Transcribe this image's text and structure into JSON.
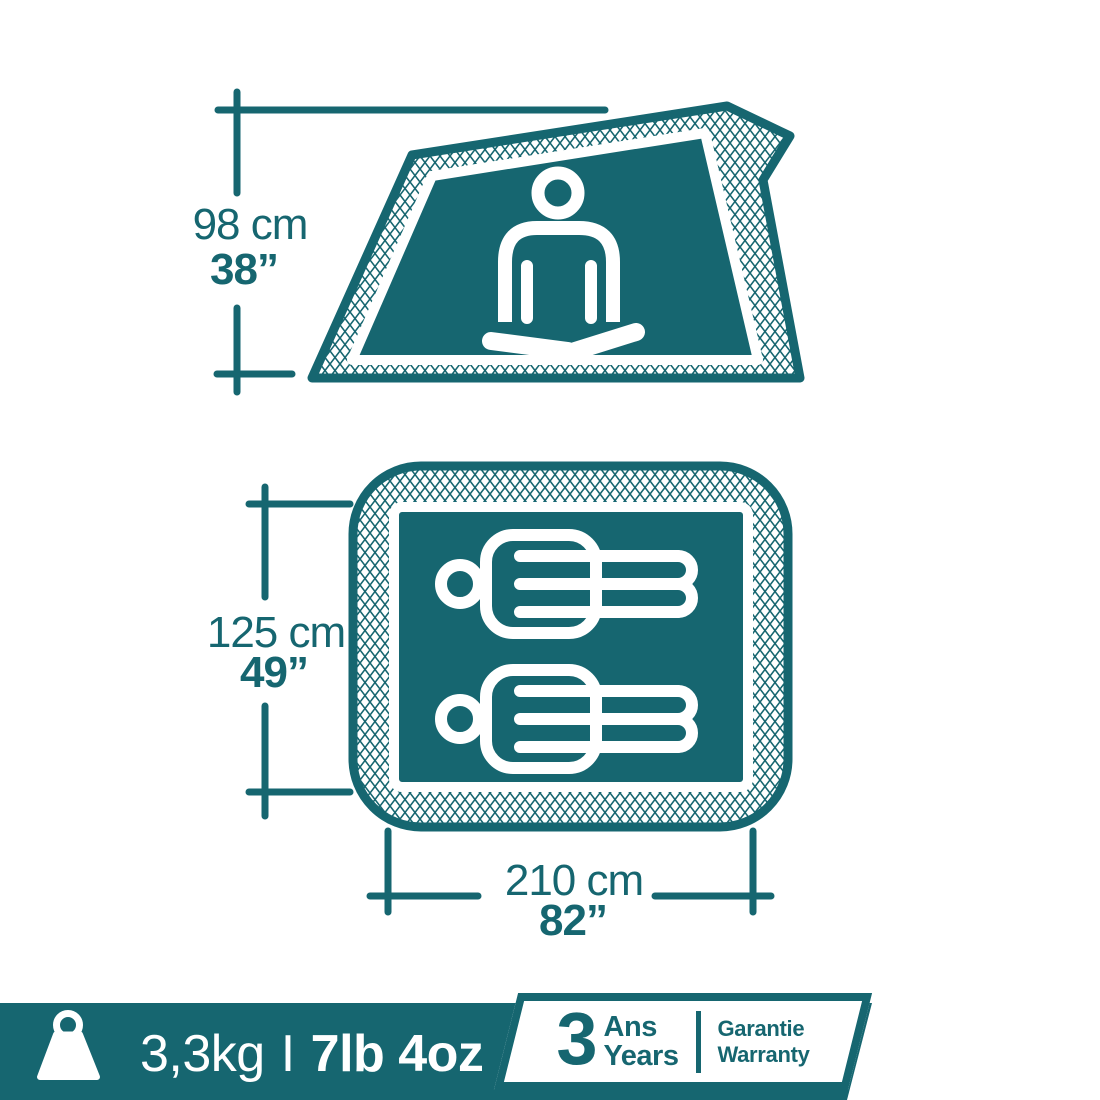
{
  "colors": {
    "teal": "#166670",
    "background": "#ffffff"
  },
  "side_view": {
    "description": "tent side profile with seated meditating person",
    "height_metric": "98 cm",
    "height_imperial": "38”"
  },
  "floor_plan": {
    "description": "tent floor plan with two lying sleepers",
    "width_metric": "125 cm",
    "width_imperial": "49”",
    "length_metric": "210 cm",
    "length_imperial": "82”"
  },
  "footer": {
    "weight_metric": "3,3kg",
    "separator": "I",
    "weight_imperial": "7lb 4oz",
    "warranty": {
      "years_number": "3",
      "unit_fr": "Ans",
      "unit_en": "Years",
      "label_fr": "Garantie",
      "label_en": "Warranty"
    }
  }
}
